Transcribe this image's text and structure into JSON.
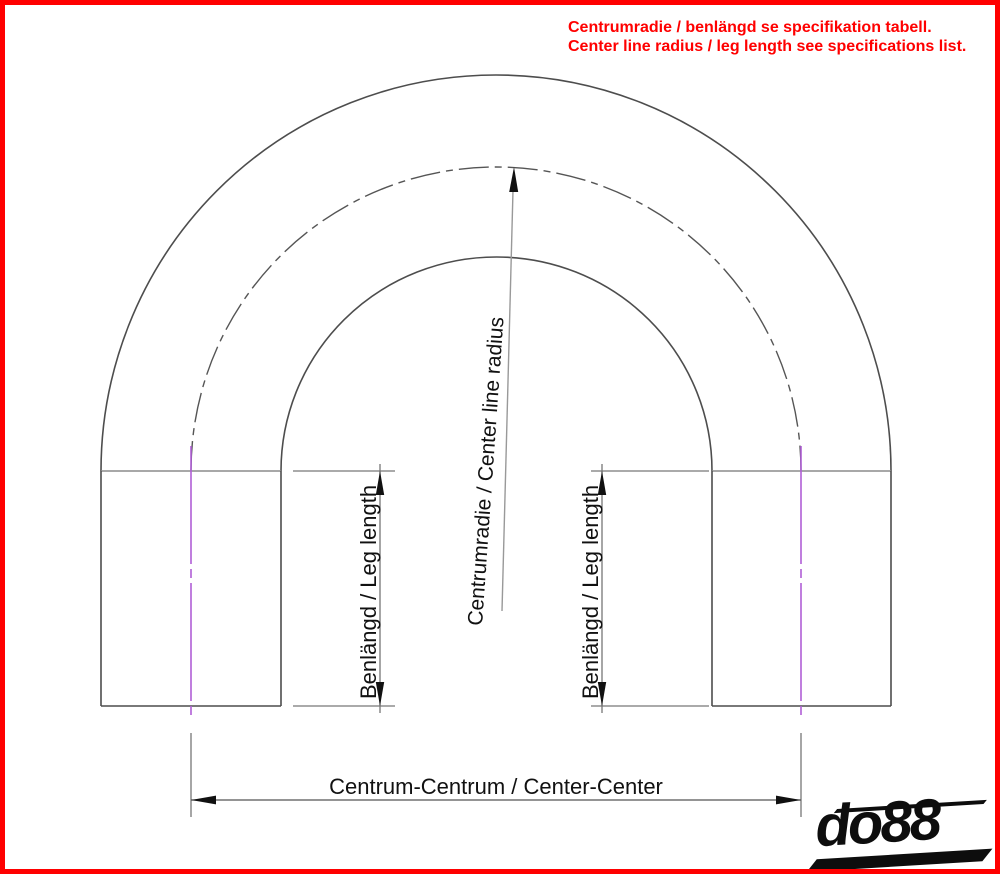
{
  "note": {
    "line1": "Centrumradie / benlängd se specifikation tabell.",
    "line2": "Center line radius / leg length see specifications list."
  },
  "labels": {
    "center_radius": "Centrumradie / Center line radius",
    "leg_length": "Benlängd / Leg length",
    "center_center": "Centrum-Centrum / Center-Center"
  },
  "logo": {
    "text": "do88"
  },
  "colors": {
    "note_red": "#ff0000",
    "border_red": "#ff0000",
    "centerline_purple": "#b05fd6",
    "drawing_line": "#4d4d4d",
    "tangent_line": "#8c8c8c",
    "dimension_line": "#777777",
    "arrow_black": "#111111",
    "logo_black": "#0d0d0d"
  }
}
